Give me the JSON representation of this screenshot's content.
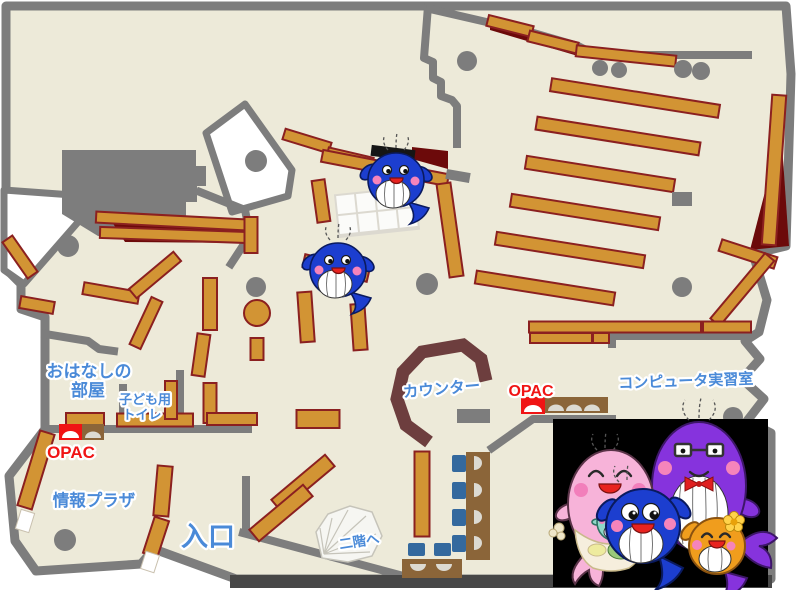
{
  "map": {
    "colors": {
      "floor": "#edead9",
      "wall": "#7d7d7d",
      "shelf": "#d29434",
      "shelf_edge": "#8b2020",
      "dark_red": "#6c0a0a",
      "counter": "#6d3e3e",
      "desk": "#8b6539",
      "chair": "#34699e",
      "label_blue": "#4a8ad8",
      "opac_red": "#f01414",
      "photo_bg": "#000000",
      "whale_blue": "#1c3ecf",
      "whale_pink": "#f7b3d9",
      "whale_purple": "#8633dd",
      "whale_orange": "#f09d1d",
      "whale_teal": "#8fd8c8"
    }
  },
  "labels": {
    "story_room_1": "おはなしの",
    "story_room_2": "部屋",
    "kids_toilet_1": "子ども用",
    "kids_toilet_2": "トイレ",
    "opac_left": "OPAC",
    "opac_right": "OPAC",
    "info_plaza": "情報プラザ",
    "entrance": "入口",
    "counter": "カウンター",
    "computer_room": "コンピュータ実習室",
    "to_second_floor": "二階へ"
  },
  "mascots": {
    "small_whales": "blue whale mascot",
    "family": "whale mascot family photo"
  }
}
